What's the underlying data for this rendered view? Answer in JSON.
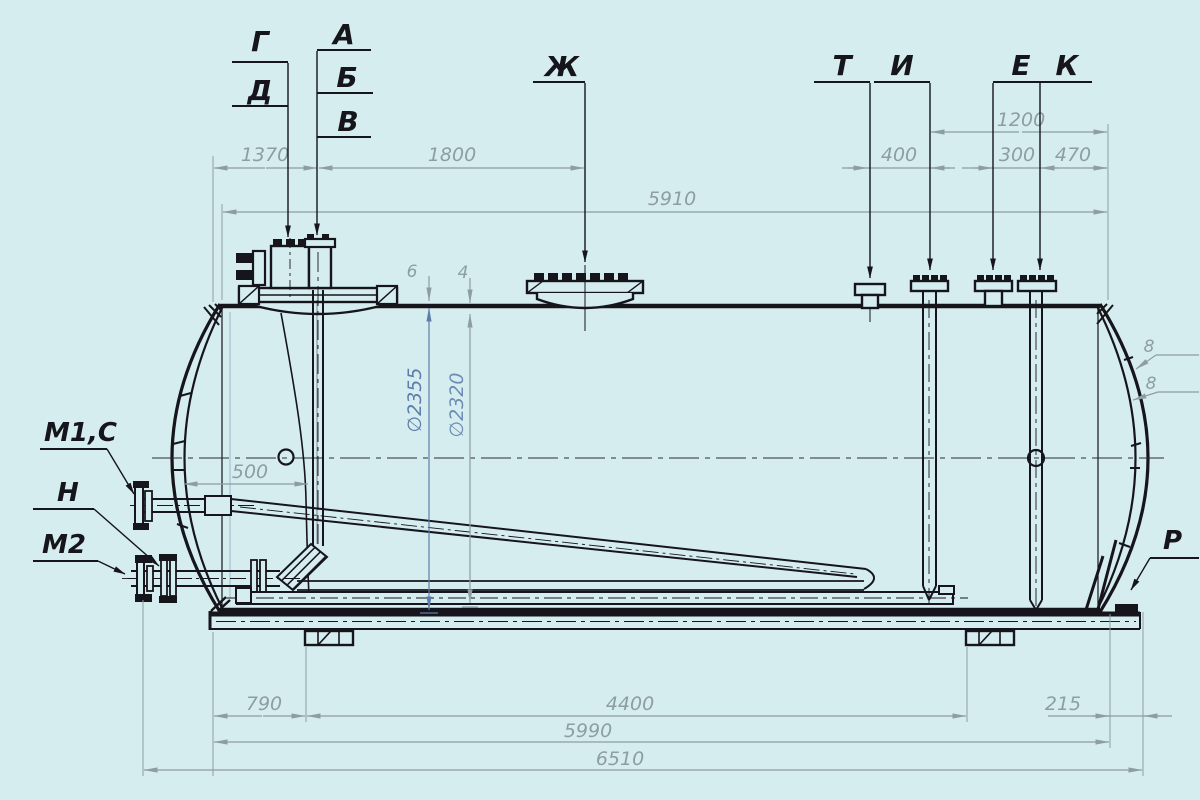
{
  "drawing": {
    "type": "technical-drawing",
    "subject": "horizontal cylindrical tank, side elevation with nozzle position marks",
    "colors": {
      "background": "#d6edef",
      "line_main": "#15151b",
      "line_dim": "#8d9da4",
      "accent_blue": "#5d7dab"
    }
  },
  "labels": {
    "top": {
      "g": "Г",
      "d": "Д",
      "a": "А",
      "b": "Б",
      "v": "В",
      "zh": "Ж",
      "t": "Т",
      "i": "И",
      "e": "Е",
      "k": "К"
    },
    "left": {
      "m1c": "М1,С",
      "n": "Н",
      "m2": "М2"
    },
    "right": {
      "p": "Р"
    }
  },
  "dims": {
    "top_row1": {
      "d1200": "1200"
    },
    "top_row2": {
      "d1370": "1370",
      "d1800": "1800",
      "d400": "400",
      "d300": "300",
      "d470": "470"
    },
    "top_row3": {
      "d5910": "5910"
    },
    "inner": {
      "d500": "500"
    },
    "dia": {
      "outer": "∅2355",
      "inner": "∅2320"
    },
    "thick": {
      "t6": "6",
      "t4": "4",
      "t8_outer": "8",
      "t8_inner": "8"
    },
    "bottom_row1": {
      "d790": "790",
      "d4400": "4400",
      "d215": "215"
    },
    "bottom_row2": {
      "d5990": "5990"
    },
    "bottom_row3": {
      "d6510": "6510"
    }
  }
}
